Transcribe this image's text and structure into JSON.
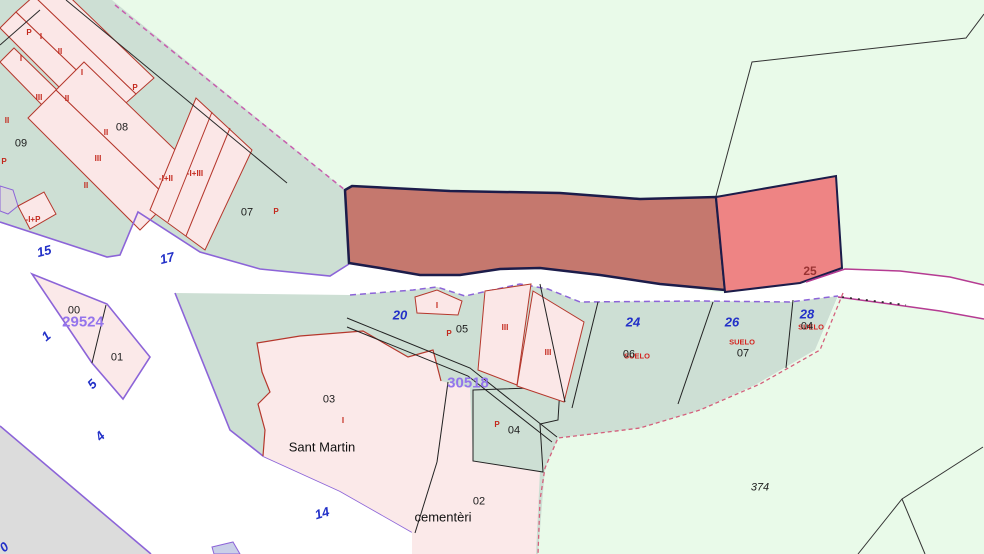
{
  "map": {
    "type": "cadastral-parcel-map",
    "colors": {
      "background_green": "#e9fae9",
      "parcel_sage": "#cddfd4",
      "building_pink": "#fbe7e7",
      "building_outline_red": "#b5372c",
      "highlight_parcel_dark": "#c5786e",
      "highlight_parcel_light": "#ee8484",
      "highlight_border_navy": "#1c1c4a",
      "boundary_purple": "#8c64d8",
      "boundary_magenta": "#b53b92",
      "boundary_pink_dashed": "#d4607c",
      "road_white": "#ffffff",
      "area_gray": "#dcdcdc",
      "label_blue": "#2230c8",
      "label_purple": "#9474ec",
      "label_red": "#c3281c",
      "label_black": "#1c1c1c"
    },
    "highlighted_parcel_label": "25",
    "reference_numbers": [
      "29524",
      "30518"
    ],
    "place_names": [
      "Sant Martin",
      "cementèri"
    ],
    "labels": [
      {
        "id": "bldg-p-1",
        "text": "P",
        "x": 29,
        "y": 33,
        "cls": "red"
      },
      {
        "id": "bldg-i-1",
        "text": "I",
        "x": 41,
        "y": 37,
        "cls": "red"
      },
      {
        "id": "bldg-i-2",
        "text": "I",
        "x": 21,
        "y": 59,
        "cls": "red"
      },
      {
        "id": "bldg-ii-1",
        "text": "II",
        "x": 60,
        "y": 52,
        "cls": "red"
      },
      {
        "id": "bldg-i-3",
        "text": "I",
        "x": 82,
        "y": 73,
        "cls": "red"
      },
      {
        "id": "bldg-iii-1",
        "text": "III",
        "x": 39,
        "y": 98,
        "cls": "red"
      },
      {
        "id": "bldg-ii-2",
        "text": "II",
        "x": 67,
        "y": 99,
        "cls": "red"
      },
      {
        "id": "bldg-ii-3",
        "text": "II",
        "x": 7,
        "y": 121,
        "cls": "red"
      },
      {
        "id": "bldg-p-2",
        "text": "P",
        "x": 135,
        "y": 88,
        "cls": "red"
      },
      {
        "id": "parcel-08",
        "text": "08",
        "x": 122,
        "y": 128,
        "cls": "black"
      },
      {
        "id": "parcel-09",
        "text": "09",
        "x": 21,
        "y": 144,
        "cls": "black"
      },
      {
        "id": "bldg-ii-4",
        "text": "II",
        "x": 106,
        "y": 133,
        "cls": "red"
      },
      {
        "id": "bldg-iii-2",
        "text": "III",
        "x": 98,
        "y": 159,
        "cls": "red"
      },
      {
        "id": "bldg-p-3",
        "text": "P",
        "x": 4,
        "y": 162,
        "cls": "red"
      },
      {
        "id": "bldg-ii-5",
        "text": "II",
        "x": 86,
        "y": 186,
        "cls": "red"
      },
      {
        "id": "bldg-m-1",
        "text": "-I+P",
        "x": 33,
        "y": 220,
        "cls": "red"
      },
      {
        "id": "bldg-m-2",
        "text": "-I+II",
        "x": 166,
        "y": 179,
        "cls": "red"
      },
      {
        "id": "bldg-m-3",
        "text": "-I+III",
        "x": 195,
        "y": 174,
        "cls": "red"
      },
      {
        "id": "parcel-07",
        "text": "07",
        "x": 247,
        "y": 213,
        "cls": "black"
      },
      {
        "id": "bldg-p-4",
        "text": "P",
        "x": 276,
        "y": 212,
        "cls": "red"
      },
      {
        "id": "road-15",
        "text": "15",
        "x": 44,
        "y": 251,
        "cls": "blue",
        "rot": -14
      },
      {
        "id": "road-17",
        "text": "17",
        "x": 167,
        "y": 258,
        "cls": "blue",
        "rot": -14
      },
      {
        "id": "parcel-25",
        "text": "25",
        "x": 810,
        "y": 271,
        "cls": "darkred"
      },
      {
        "id": "road-1",
        "text": "1",
        "x": 46,
        "y": 336,
        "cls": "blue",
        "rot": -40
      },
      {
        "id": "parcel-00",
        "text": "00",
        "x": 74,
        "y": 311,
        "cls": "black"
      },
      {
        "id": "ref-29524",
        "text": "29524",
        "x": 83,
        "y": 322,
        "cls": "purple"
      },
      {
        "id": "parcel-01",
        "text": "01",
        "x": 117,
        "y": 358,
        "cls": "black"
      },
      {
        "id": "road-5",
        "text": "5",
        "x": 92,
        "y": 384,
        "cls": "blue",
        "rot": -45
      },
      {
        "id": "road-4",
        "text": "4",
        "x": 100,
        "y": 436,
        "cls": "blue",
        "rot": -45
      },
      {
        "id": "road-0",
        "text": "0",
        "x": 4,
        "y": 547,
        "cls": "blue",
        "rot": -40
      },
      {
        "id": "road-20",
        "text": "20",
        "x": 400,
        "y": 315,
        "cls": "blue"
      },
      {
        "id": "bldg-i-4",
        "text": "I",
        "x": 437,
        "y": 306,
        "cls": "red"
      },
      {
        "id": "parcel-05",
        "text": "05",
        "x": 462,
        "y": 330,
        "cls": "black"
      },
      {
        "id": "bldg-p-5",
        "text": "P",
        "x": 449,
        "y": 334,
        "cls": "red"
      },
      {
        "id": "ref-30518",
        "text": "30518",
        "x": 468,
        "y": 383,
        "cls": "purple"
      },
      {
        "id": "bldg-iii-3",
        "text": "III",
        "x": 505,
        "y": 328,
        "cls": "red"
      },
      {
        "id": "bldg-iii-4",
        "text": "III",
        "x": 548,
        "y": 353,
        "cls": "red"
      },
      {
        "id": "parcel-24",
        "text": "24",
        "x": 633,
        "y": 322,
        "cls": "blue"
      },
      {
        "id": "suelo-1",
        "text": "SUELO",
        "x": 637,
        "y": 356,
        "cls": "suelo"
      },
      {
        "id": "parcel-06",
        "text": "06",
        "x": 629,
        "y": 355,
        "cls": "black"
      },
      {
        "id": "parcel-26",
        "text": "26",
        "x": 732,
        "y": 322,
        "cls": "blue"
      },
      {
        "id": "suelo-2",
        "text": "SUELO",
        "x": 742,
        "y": 342,
        "cls": "suelo"
      },
      {
        "id": "parcel-07b",
        "text": "07",
        "x": 743,
        "y": 354,
        "cls": "black"
      },
      {
        "id": "parcel-28",
        "text": "28",
        "x": 807,
        "y": 314,
        "cls": "blue"
      },
      {
        "id": "suelo-3",
        "text": "SUELO",
        "x": 811,
        "y": 327,
        "cls": "suelo"
      },
      {
        "id": "parcel-04b",
        "text": "04",
        "x": 807,
        "y": 327,
        "cls": "black"
      },
      {
        "id": "parcel-03",
        "text": "03",
        "x": 329,
        "y": 400,
        "cls": "black"
      },
      {
        "id": "bldg-i-5",
        "text": "I",
        "x": 343,
        "y": 421,
        "cls": "red"
      },
      {
        "id": "name-sant-martin",
        "text": "Sant Martin",
        "x": 322,
        "y": 447,
        "cls": "name"
      },
      {
        "id": "bldg-p-6",
        "text": "P",
        "x": 497,
        "y": 425,
        "cls": "red"
      },
      {
        "id": "parcel-04",
        "text": "04",
        "x": 514,
        "y": 431,
        "cls": "black"
      },
      {
        "id": "parcel-02",
        "text": "02",
        "x": 479,
        "y": 502,
        "cls": "black"
      },
      {
        "id": "name-cementeri",
        "text": "cementèri",
        "x": 443,
        "y": 517,
        "cls": "name"
      },
      {
        "id": "road-14",
        "text": "14",
        "x": 322,
        "y": 513,
        "cls": "blue",
        "rot": -16
      },
      {
        "id": "parcel-374",
        "text": "374",
        "x": 760,
        "y": 488,
        "cls": "black italic"
      }
    ]
  }
}
